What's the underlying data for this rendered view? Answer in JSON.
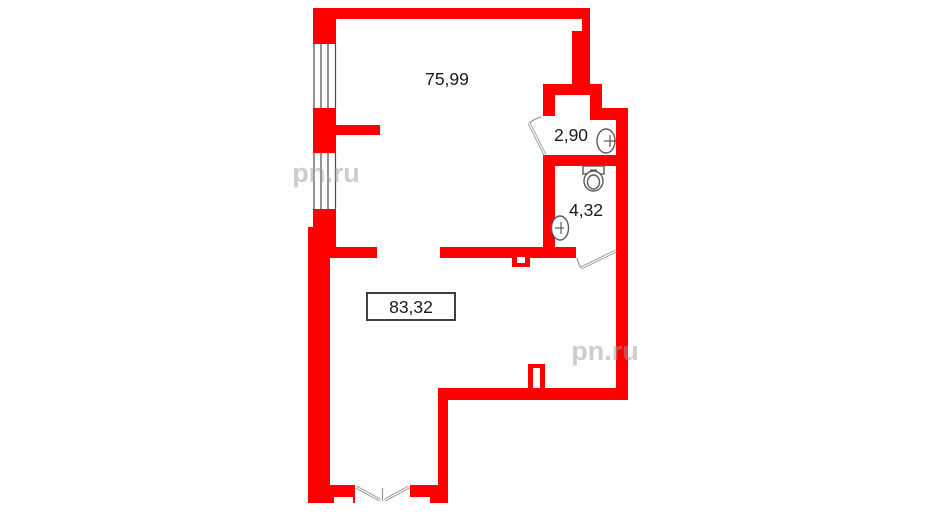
{
  "colors": {
    "wall": "#ff0000",
    "line": "#4d4d4d",
    "door": "#9a9a9a",
    "fixture": "#5a5a5a",
    "label": "#1a1a1a",
    "label_box_border": "#3f3f3f",
    "watermark": "#9c9c9c",
    "background": "#ffffff"
  },
  "rooms": [
    {
      "area_label": "75,99"
    },
    {
      "area_label": "2,90"
    },
    {
      "area_label": "4,32"
    },
    {
      "area_label": "83,32"
    }
  ],
  "fixtures": {
    "sink_top": "sink",
    "toilet": "toilet",
    "sink_bottom": "sink"
  },
  "watermark": {
    "text": "pn.ru"
  }
}
